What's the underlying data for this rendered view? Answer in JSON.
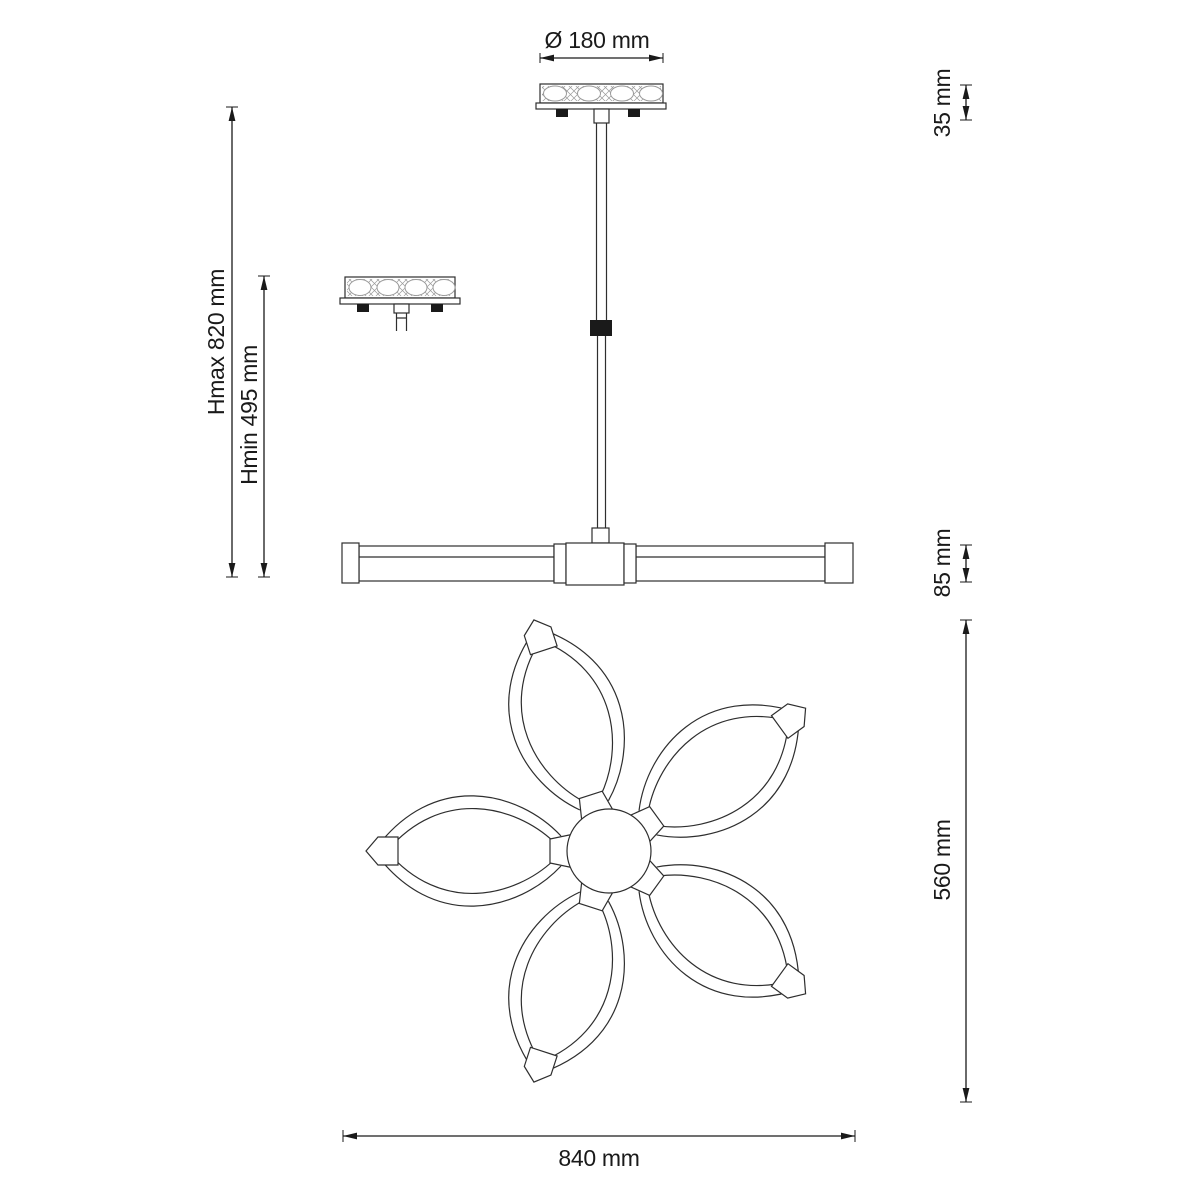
{
  "diagram": {
    "dimensions": {
      "canopy_diameter": "Ø 180 mm",
      "canopy_height": "35 mm",
      "height_max": "Hmax 820 mm",
      "height_min": "Hmin 495 mm",
      "bar_height": "85 mm",
      "fixture_depth": "560 mm",
      "fixture_width": "840 mm"
    }
  },
  "colors": {
    "background": "#ffffff",
    "line": "#2e2e2e",
    "line_soft": "#9a9a9a",
    "dim": "#1a1a1a"
  }
}
